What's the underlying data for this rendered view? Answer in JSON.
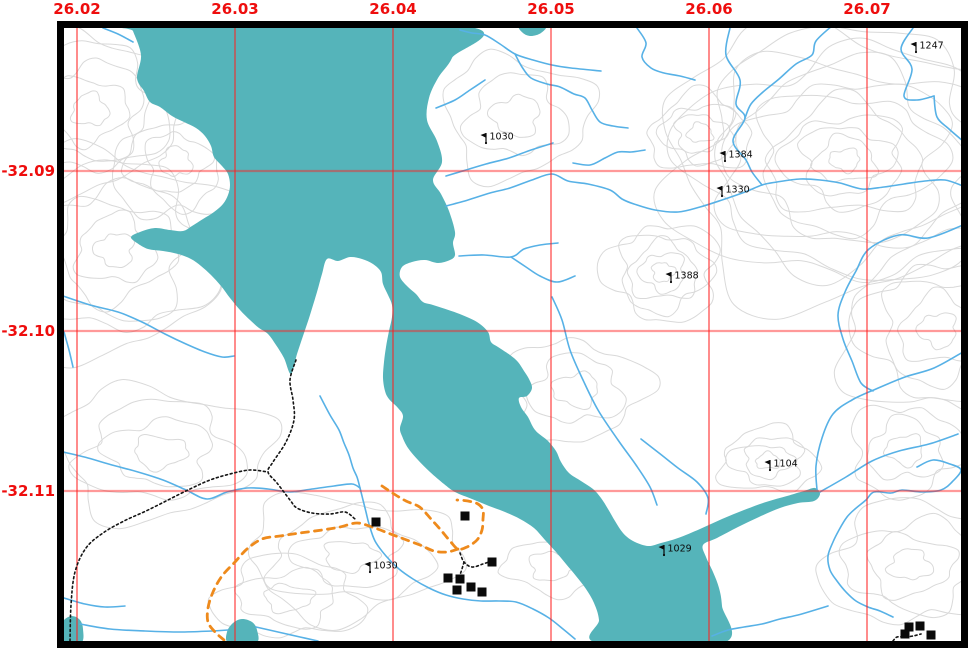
{
  "map": {
    "title": "topographic-map-canvas",
    "colors": {
      "water": "#55b4ba",
      "stream": "#57b1e6",
      "contour": "#d9d9d9",
      "road": "#ee8a1c",
      "track": "#151515",
      "grid_line": "#ff1f1f",
      "grid_label": "#ee0d0d",
      "building": "#0a0a0a",
      "frame": "#000000",
      "land": "#ffffff"
    },
    "icons": {
      "spot_marker": "flag-icon",
      "building": "building-square-icon"
    }
  },
  "grid": {
    "top_labels": [
      {
        "text": "26.02",
        "x": 77
      },
      {
        "text": "26.03",
        "x": 235
      },
      {
        "text": "26.04",
        "x": 393
      },
      {
        "text": "26.05",
        "x": 551
      },
      {
        "text": "26.06",
        "x": 709
      },
      {
        "text": "26.07",
        "x": 867
      }
    ],
    "left_labels": [
      {
        "text": "-32.09",
        "y": 171
      },
      {
        "text": "-32.10",
        "y": 331
      },
      {
        "text": "-32.11",
        "y": 491
      }
    ]
  },
  "spot_heights": [
    {
      "label": "1247",
      "x": 916,
      "y": 52
    },
    {
      "label": "1030",
      "x": 486,
      "y": 143
    },
    {
      "label": "1384",
      "x": 725,
      "y": 161
    },
    {
      "label": "1330",
      "x": 722,
      "y": 196
    },
    {
      "label": "1388",
      "x": 671,
      "y": 282
    },
    {
      "label": "1104",
      "x": 770,
      "y": 470
    },
    {
      "label": "1029",
      "x": 664,
      "y": 555
    },
    {
      "label": "1030",
      "x": 370,
      "y": 572
    }
  ],
  "buildings": [
    {
      "x": 376,
      "y": 522
    },
    {
      "x": 465,
      "y": 516
    },
    {
      "x": 492,
      "y": 562
    },
    {
      "x": 448,
      "y": 578
    },
    {
      "x": 460,
      "y": 579
    },
    {
      "x": 457,
      "y": 590
    },
    {
      "x": 471,
      "y": 587
    },
    {
      "x": 482,
      "y": 592
    },
    {
      "x": 909,
      "y": 627
    },
    {
      "x": 920,
      "y": 626
    },
    {
      "x": 905,
      "y": 634
    },
    {
      "x": 931,
      "y": 635
    }
  ]
}
